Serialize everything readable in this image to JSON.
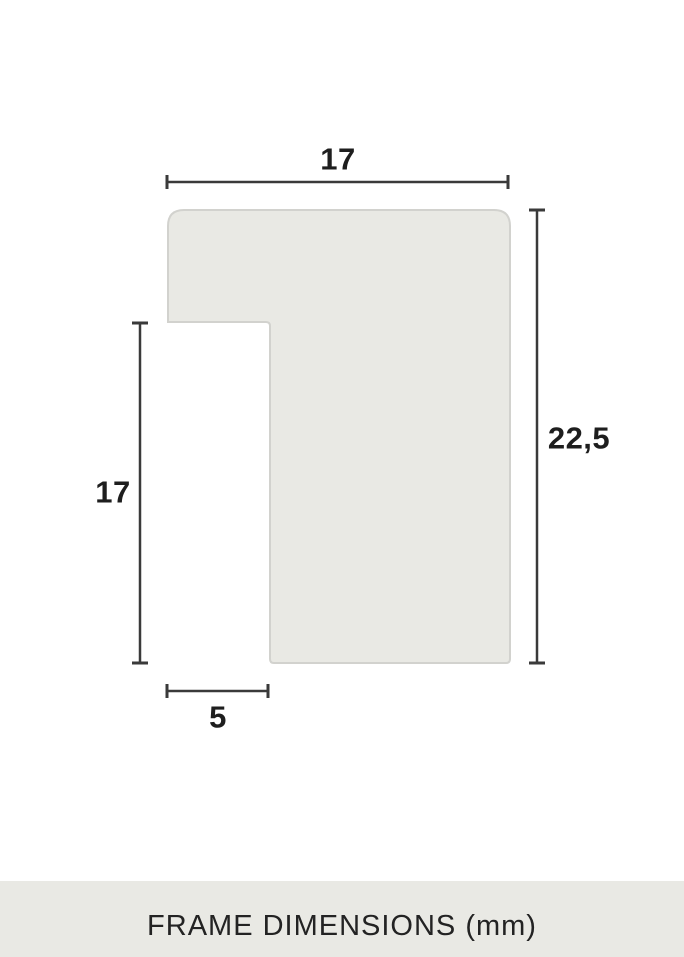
{
  "diagram": {
    "dimensions": {
      "top_width": "17",
      "right_height": "22,5",
      "left_height": "17",
      "bottom_width": "5"
    },
    "colors": {
      "shape_fill": "#e9e9e4",
      "shape_border": "#d2d2ce",
      "dimension_line": "#3a3a3a",
      "label_text": "#1e1e1e",
      "footer_background": "#e9e9e4",
      "footer_text": "#232323"
    }
  },
  "footer": {
    "label": "FRAME DIMENSIONS (mm)"
  }
}
